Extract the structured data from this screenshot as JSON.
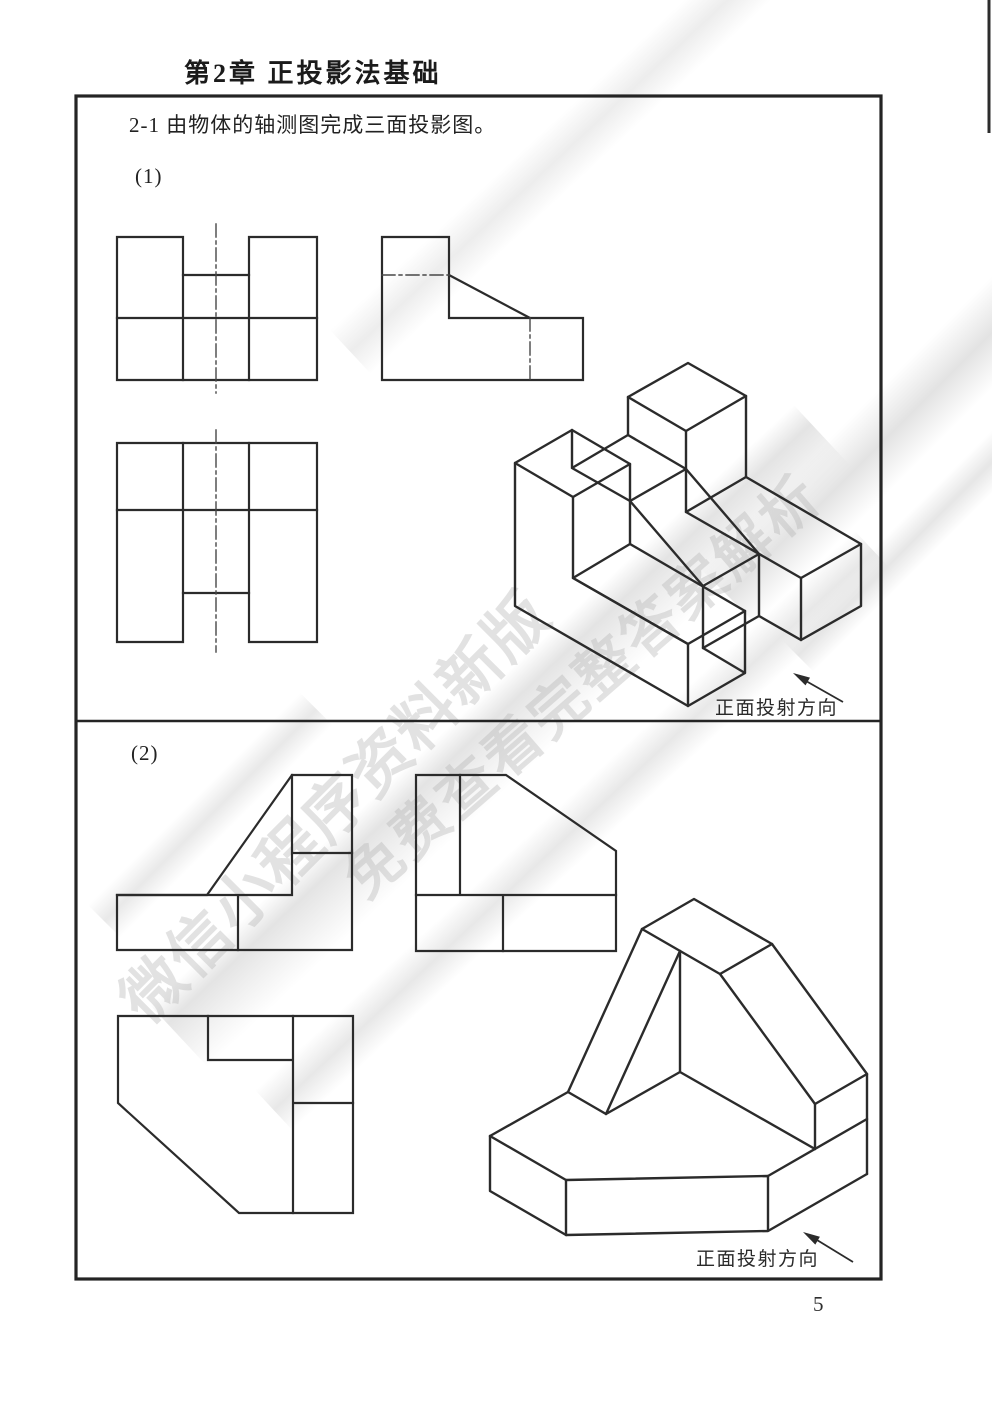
{
  "page": {
    "chapter_title": "第2章  正投影法基础",
    "exercise_title": "2-1 由物体的轴测图完成三面投影图。",
    "page_number": "5"
  },
  "sections": [
    {
      "label": "(1)",
      "projection_label": "正面投射方向"
    },
    {
      "label": "(2)",
      "projection_label": "正面投射方向"
    }
  ],
  "watermark": {
    "line1": "微信小程序资料新版",
    "line2": "免费查看完整答案解析",
    "color": "#b2b2b2"
  },
  "colors": {
    "drawing_line": "#2b2b2b",
    "centerline": "#474747",
    "border": "#242424",
    "paper": "#ffffff"
  }
}
